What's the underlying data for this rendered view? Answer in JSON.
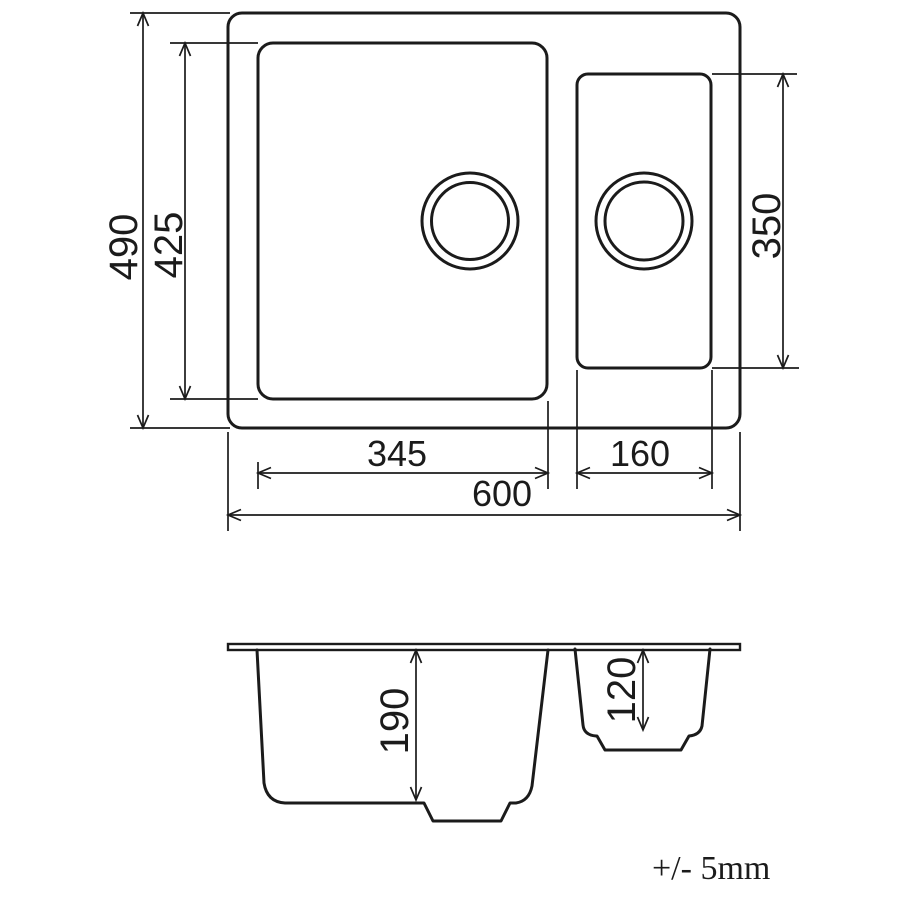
{
  "drawing": {
    "tolerance_note": "+/- 5mm",
    "top_view": {
      "overall_width": "600",
      "overall_depth": "490",
      "main_bowl_width": "345",
      "main_bowl_depth": "425",
      "half_bowl_width": "160",
      "half_bowl_depth": "350"
    },
    "section_view": {
      "main_bowl_height": "190",
      "half_bowl_height": "120"
    },
    "colors": {
      "line": "#1b1b1b",
      "background": "#ffffff"
    }
  }
}
